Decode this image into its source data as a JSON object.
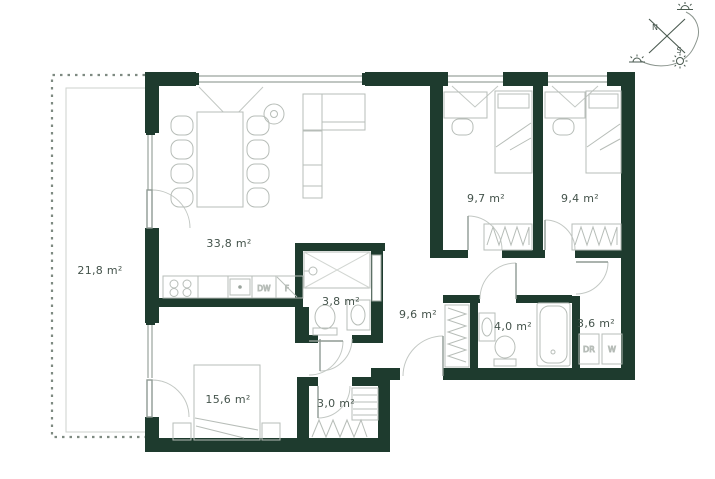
{
  "plan": {
    "rooms": {
      "balcony": {
        "area": "21,8 m²"
      },
      "living": {
        "area": "33,8 m²"
      },
      "bath_small": {
        "area": "3,8 m²"
      },
      "hall": {
        "area": "9,6 m²"
      },
      "bedroom1": {
        "area": "9,7 m²"
      },
      "bedroom2": {
        "area": "9,4 m²"
      },
      "bath_main": {
        "area": "4,0 m²"
      },
      "laundry": {
        "area": "3,6 m²"
      },
      "bedroom_master": {
        "area": "15,6 m²"
      },
      "closet": {
        "area": "3,0 m²"
      }
    },
    "appliances": {
      "dishwasher": "DW",
      "fridge": "F",
      "dryer": "DR",
      "washer": "W"
    },
    "compass": {
      "north": "N",
      "south": "S"
    },
    "colors": {
      "wall": "#1e3b2e",
      "furniture_line": "#b7bdb8",
      "window_line": "#9aa49d",
      "label_text": "#44534b"
    }
  }
}
